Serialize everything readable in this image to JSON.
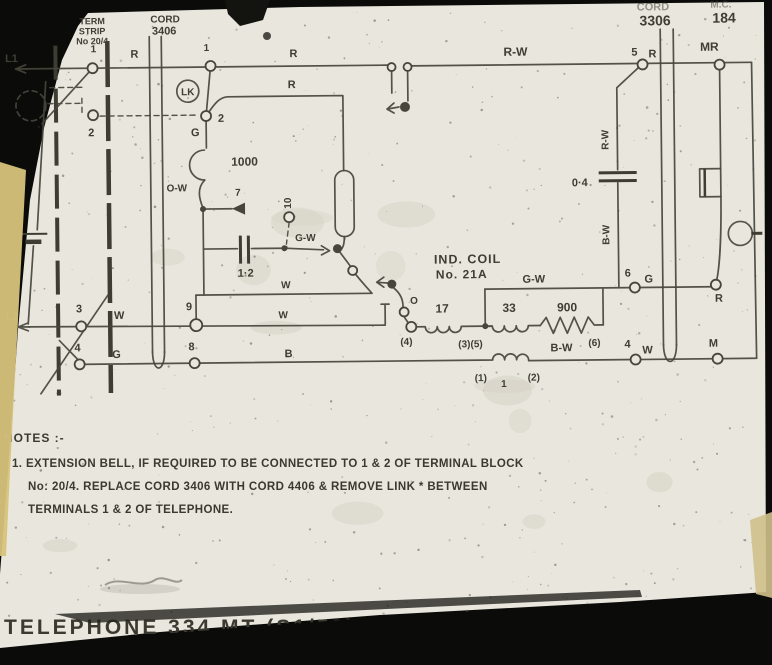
{
  "colors": {
    "background": "#0b0b09",
    "paper": "#e8e6dd",
    "ink": "#46463c",
    "tape": "#d8c37c"
  },
  "header": {
    "term_strip_line1": "TERM",
    "term_strip_line2": "STRIP",
    "term_strip_line3": "No 20/4",
    "cord_left_line1": "CORD",
    "cord_left_line2": "3406",
    "cord_right_line1": "CORD",
    "cord_right_line2": "3306",
    "mc_line1": "M.C.",
    "mc_line2": "184"
  },
  "labels": {
    "l1": "L1",
    "l2": "L2",
    "one": "1",
    "two": "2",
    "three": "3",
    "four": "4",
    "five": "5",
    "six": "6",
    "seven": "7",
    "eight": "8",
    "nine": "9",
    "ten": "10",
    "r": "R",
    "w": "W",
    "g": "G",
    "b": "B",
    "m": "M",
    "o": "O",
    "rw": "R-W",
    "gw": "G-W",
    "bw": "B-W",
    "ow": "O-W",
    "mr": "MR",
    "lk": "LK",
    "bell_coil": "1000",
    "cap_1_2": "1·2",
    "cap_0_4": "0·4",
    "winding_17": "17",
    "winding_33": "33",
    "resistor_900": "900",
    "term_p1": "(1)",
    "term_p2": "(2)",
    "term_p4": "(4)",
    "term_p35": "(3)(5)",
    "term_p6": "(6)",
    "ind_coil_line1": "IND. COIL",
    "ind_coil_line2": "No. 21A"
  },
  "notes": {
    "heading": "NOTES :-",
    "line1": "1. EXTENSION BELL, IF REQUIRED TO BE CONNECTED TO 1 & 2 OF TERMINAL BLOCK",
    "line2": "No: 20/4. REPLACE CORD 3406 WITH CORD 4406 & REMOVE LINK * BETWEEN",
    "line3": "TERMINALS 1 & 2 OF TELEPHONE."
  },
  "title": {
    "main": "TELEPHONE 334 MT (S1/58)",
    "sub": "ERICSSON TYPE N2120KI, MK II CE-11106"
  }
}
